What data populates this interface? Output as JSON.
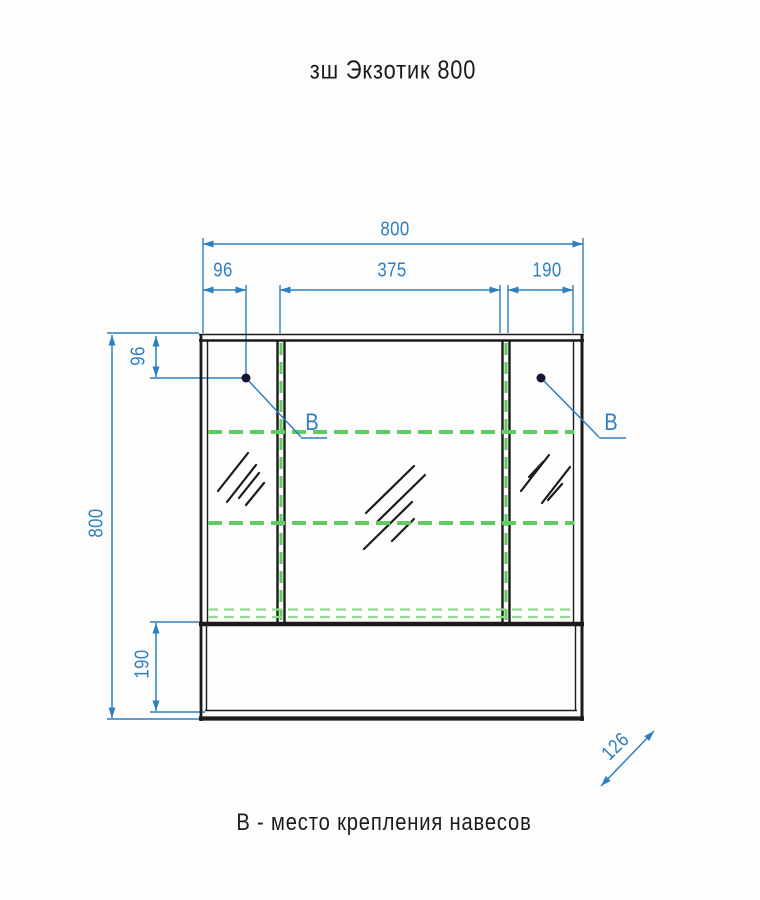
{
  "title": "зш Экзотик 800",
  "caption": "В - место крепления навесов",
  "dims": {
    "overall_width": "800",
    "left_section_width": "96",
    "middle_section_width": "375",
    "right_section_width": "190",
    "mount_offset_top": "96",
    "overall_height": "800",
    "bottom_shelf_height": "190",
    "depth": "126"
  },
  "mount_labels": {
    "left": "В",
    "right": "В"
  },
  "colors": {
    "dimension_blue": "#2e7fbe",
    "outline_black": "#1b1b1b",
    "shelf_green": "#5ecc60",
    "shelf_green_light": "#8edc8e",
    "mount_dot": "#16162e",
    "background": "#fdfdfd"
  }
}
